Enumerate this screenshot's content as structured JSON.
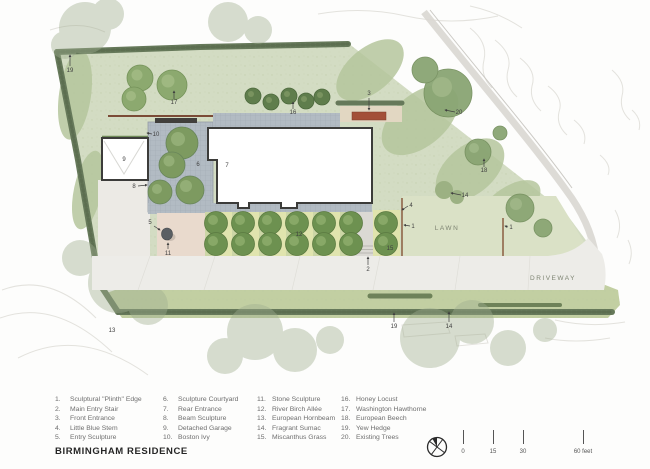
{
  "title": "BIRMINGHAM RESIDENCE",
  "plan": {
    "area_labels": [
      {
        "text": "LAWN",
        "x": 447,
        "y": 230
      },
      {
        "text": "DRIVEWAY",
        "x": 553,
        "y": 280
      }
    ],
    "callouts": [
      {
        "n": "19",
        "x": 70,
        "y": 72,
        "line": [
          70,
          66,
          70,
          55
        ]
      },
      {
        "n": "17",
        "x": 174,
        "y": 104,
        "line": [
          174,
          99,
          174,
          91
        ]
      },
      {
        "n": "16",
        "x": 293,
        "y": 114,
        "line": [
          293,
          109,
          293,
          102
        ]
      },
      {
        "n": "3",
        "x": 369,
        "y": 95,
        "line": [
          369,
          98,
          369,
          110
        ]
      },
      {
        "n": "20",
        "x": 459,
        "y": 114,
        "line": [
          455,
          112,
          445,
          110
        ]
      },
      {
        "n": "18",
        "x": 484,
        "y": 172,
        "line": [
          484,
          167,
          484,
          159
        ]
      },
      {
        "n": "14",
        "x": 465,
        "y": 197,
        "line": [
          461,
          195,
          451,
          193
        ]
      },
      {
        "n": "10",
        "x": 156,
        "y": 136,
        "line": [
          152,
          134,
          147,
          133
        ]
      },
      {
        "n": "9",
        "x": 124,
        "y": 161
      },
      {
        "n": "8",
        "x": 134,
        "y": 188,
        "line": [
          138,
          186,
          147,
          185
        ]
      },
      {
        "n": "6",
        "x": 198,
        "y": 166
      },
      {
        "n": "7",
        "x": 227,
        "y": 167
      },
      {
        "n": "5",
        "x": 150,
        "y": 224,
        "line": [
          154,
          226,
          160,
          230
        ]
      },
      {
        "n": "11",
        "x": 168,
        "y": 255,
        "line": [
          168,
          249,
          168,
          243
        ]
      },
      {
        "n": "2",
        "x": 368,
        "y": 271,
        "line": [
          368,
          265,
          368,
          257
        ]
      },
      {
        "n": "12",
        "x": 299,
        "y": 236
      },
      {
        "n": "4",
        "x": 411,
        "y": 207,
        "line": [
          408,
          206,
          402,
          210
        ]
      },
      {
        "n": "15",
        "x": 390,
        "y": 250
      },
      {
        "n": "1",
        "x": 413,
        "y": 228,
        "line": [
          410,
          226,
          404,
          225
        ]
      },
      {
        "n": "1",
        "x": 511,
        "y": 229,
        "line": [
          508,
          227,
          505,
          226
        ]
      },
      {
        "n": "19",
        "x": 394,
        "y": 328,
        "line": [
          394,
          322,
          394,
          313
        ]
      },
      {
        "n": "14",
        "x": 449,
        "y": 328,
        "line": [
          449,
          322,
          449,
          312
        ]
      },
      {
        "n": "13",
        "x": 112,
        "y": 332
      }
    ]
  },
  "legend": {
    "columns": [
      [
        {
          "num": "1.",
          "label": "Sculptural \"Plinth\" Edge"
        },
        {
          "num": "2.",
          "label": "Main Entry Stair"
        },
        {
          "num": "3.",
          "label": "Front Entrance"
        },
        {
          "num": "4.",
          "label": "Little Blue Stem"
        },
        {
          "num": "5.",
          "label": "Entry Sculpture"
        }
      ],
      [
        {
          "num": "6.",
          "label": "Sculpture Courtyard"
        },
        {
          "num": "7.",
          "label": "Rear Entrance"
        },
        {
          "num": "8.",
          "label": "Beam Sculpture"
        },
        {
          "num": "9.",
          "label": "Detached Garage"
        },
        {
          "num": "10.",
          "label": "Boston Ivy"
        }
      ],
      [
        {
          "num": "11.",
          "label": "Stone Sculpture"
        },
        {
          "num": "12.",
          "label": "River Birch Allée"
        },
        {
          "num": "13.",
          "label": "European Hornbeam"
        },
        {
          "num": "14.",
          "label": "Fragrant Sumac"
        },
        {
          "num": "15.",
          "label": "Miscanthus Grass"
        }
      ],
      [
        {
          "num": "16.",
          "label": "Honey Locust"
        },
        {
          "num": "17.",
          "label": "Washington Hawthorne"
        },
        {
          "num": "18.",
          "label": "European Beech"
        },
        {
          "num": "19.",
          "label": "Yew Hedge"
        },
        {
          "num": "20.",
          "label": "Existing Trees"
        }
      ]
    ]
  },
  "footer": {
    "scale": {
      "ticks": [
        {
          "label": "0",
          "x": 0
        },
        {
          "label": "15",
          "x": 30
        },
        {
          "label": "30",
          "x": 60
        },
        {
          "label": "60 feet",
          "x": 120
        }
      ]
    },
    "north_icon": "north-arrow"
  },
  "colors": {
    "site_green": "#d3dcc3",
    "lawn_green": "#dae1c6",
    "strip_green": "#c2cfa2",
    "hedge_green": "#66795a",
    "tree_green": "#6d9150",
    "paving_gray": "#b2bbc3",
    "driveway_gray": "#edece8",
    "entry_red": "#a34f38",
    "court_pink": "#e9dacd",
    "tan_band": "#e2d7c2",
    "contour_gray": "#e3e2dd",
    "ink": "#3c3c3a"
  }
}
